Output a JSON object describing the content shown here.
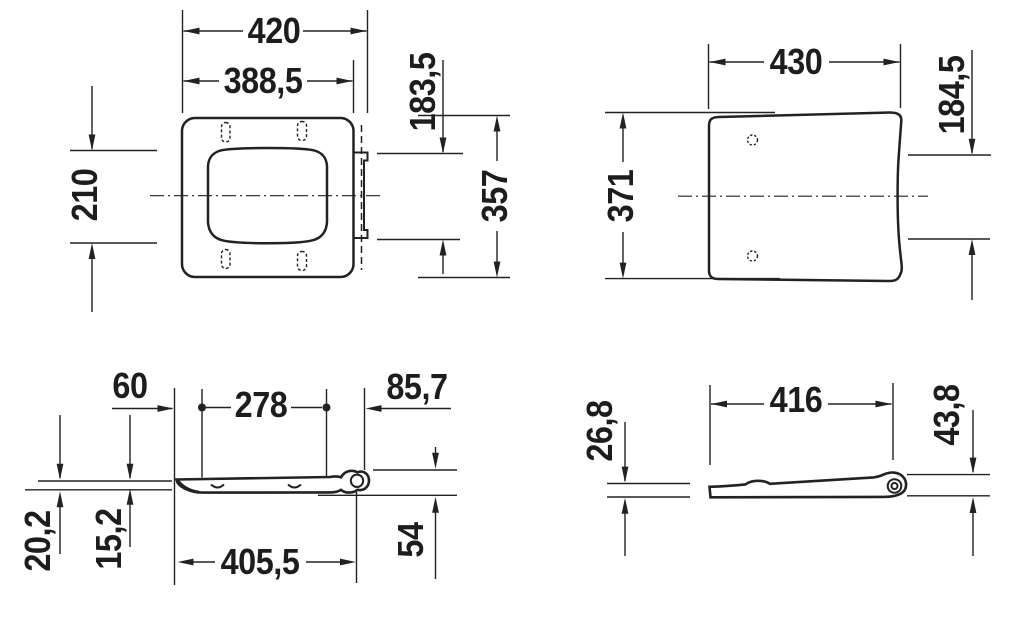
{
  "drawing": {
    "background": "#ffffff",
    "line_color": "#222222",
    "views": {
      "seat_top_view": {
        "dims": {
          "outer_width": "420",
          "inner_width": "388,5",
          "right_offset": "183,5",
          "half_depth": "210",
          "overall_depth": "357"
        }
      },
      "lid_top_view": {
        "dims": {
          "width": "430",
          "depth": "371",
          "right_offset": "184,5"
        }
      },
      "seat_side_view": {
        "dims": {
          "front_to_bumper": "60",
          "bumper_spacing": "278",
          "hinge_offset": "85,7",
          "front_height": "20,2",
          "profile_height": "15,2",
          "overall_length": "405,5",
          "hinge_height": "54"
        }
      },
      "lid_side_view": {
        "dims": {
          "overall_length": "416",
          "front_height": "26,8",
          "hinge_height": "43,8"
        }
      }
    }
  }
}
